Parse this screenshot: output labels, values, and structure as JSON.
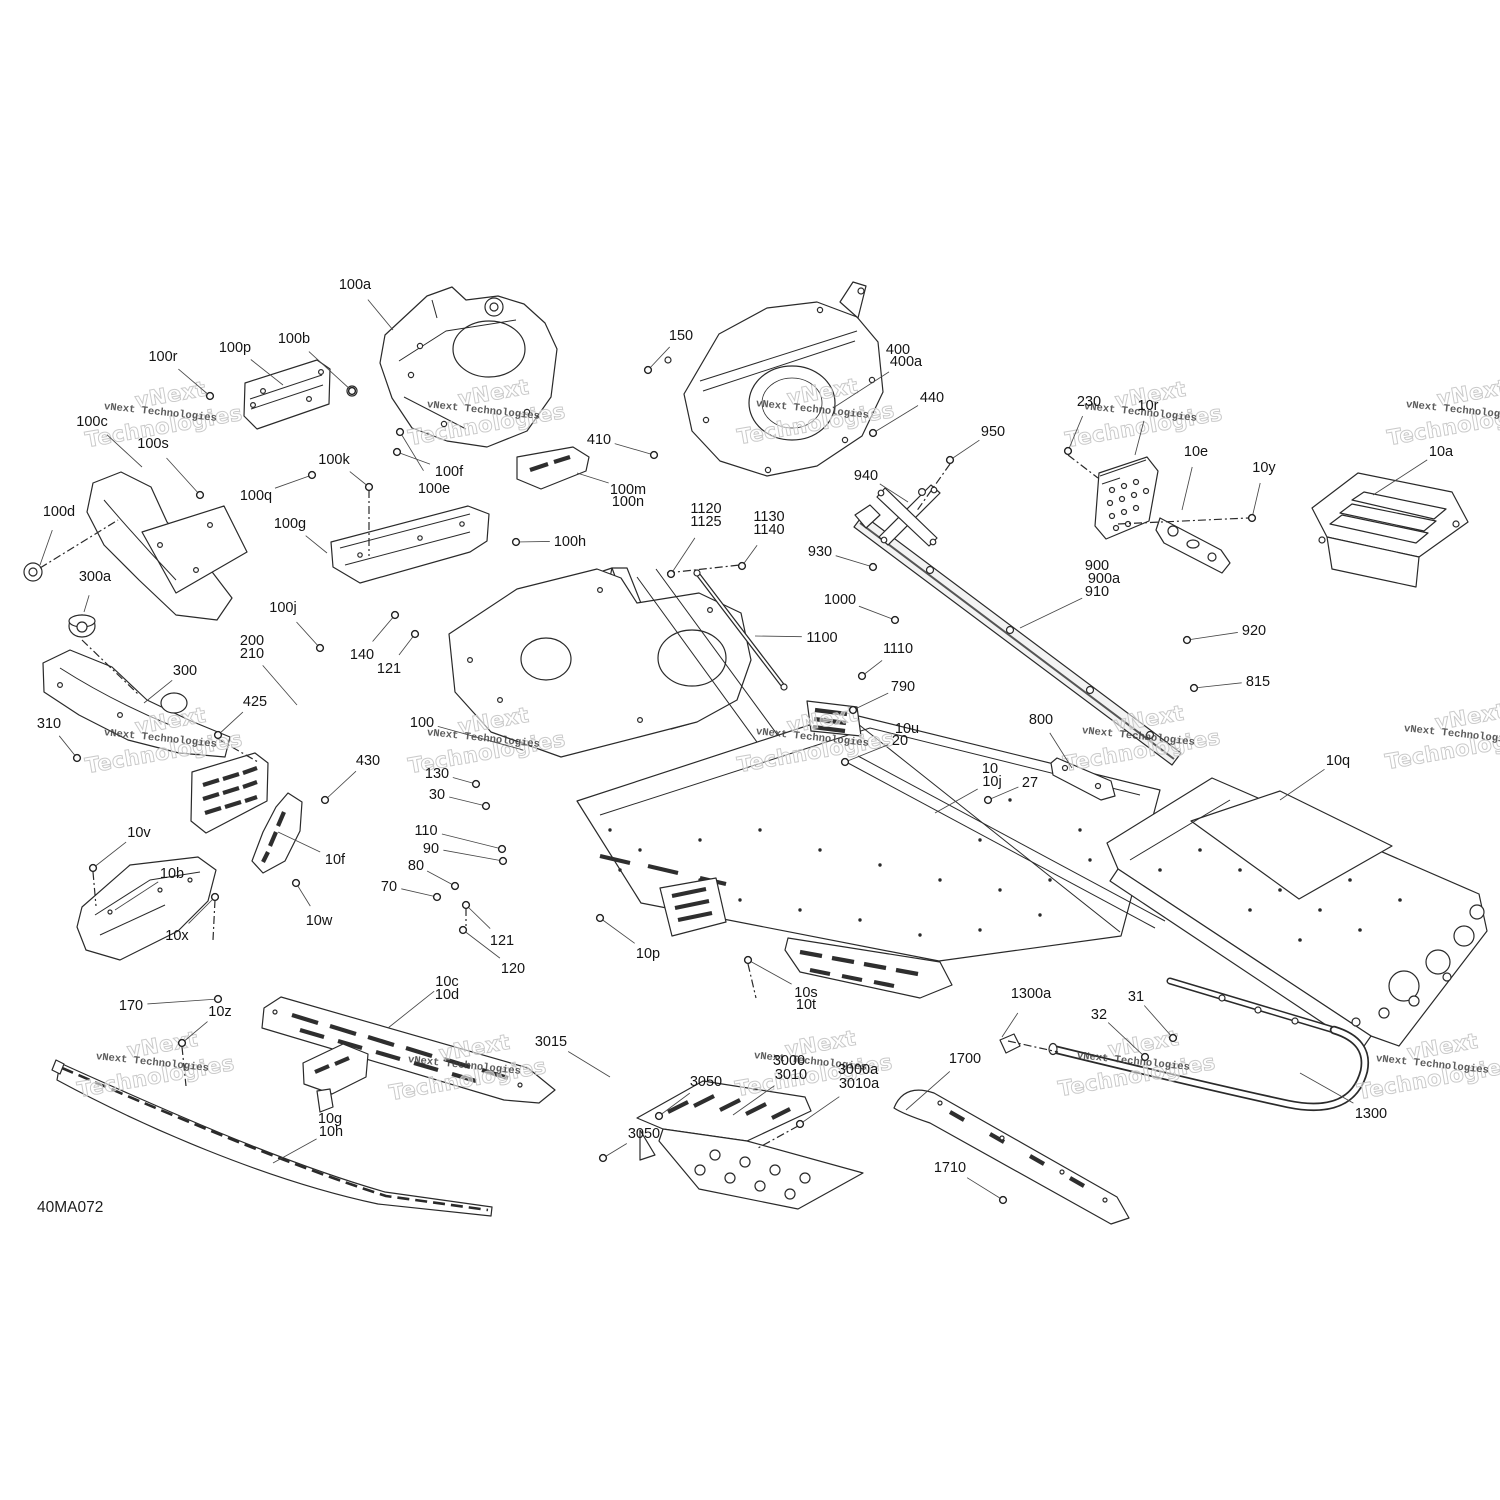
{
  "document": {
    "type": "exploded-parts-diagram",
    "subject": "frame-and-chassis-assembly",
    "drawing_code": "40MA072",
    "watermark": {
      "small": "vNext Technologies",
      "big_line1": "vNext",
      "big_line2": "Technologies"
    },
    "line_color": "#2a2a2a",
    "background_color": "#ffffff"
  },
  "watermark_positions": [
    [
      160,
      416
    ],
    [
      483,
      414
    ],
    [
      812,
      413
    ],
    [
      1140,
      416
    ],
    [
      1462,
      414
    ],
    [
      160,
      742
    ],
    [
      483,
      742
    ],
    [
      812,
      741
    ],
    [
      1138,
      740
    ],
    [
      1460,
      738
    ],
    [
      152,
      1066
    ],
    [
      464,
      1069
    ],
    [
      810,
      1065
    ],
    [
      1133,
      1065
    ],
    [
      1432,
      1068
    ]
  ],
  "labels": [
    {
      "t": "100a",
      "x": 355,
      "y": 284,
      "tx": 393,
      "ty": 330
    },
    {
      "t": "100r",
      "x": 163,
      "y": 356,
      "tx": 210,
      "ty": 396,
      "hw": 1
    },
    {
      "t": "100p",
      "x": 235,
      "y": 347,
      "tx": 283,
      "ty": 385
    },
    {
      "t": "100b",
      "x": 294,
      "y": 338,
      "tx": 352,
      "ty": 391,
      "hw": 1
    },
    {
      "t": "100c",
      "x": 92,
      "y": 421,
      "tx": 142,
      "ty": 467
    },
    {
      "t": "100s",
      "x": 153,
      "y": 443,
      "tx": 200,
      "ty": 495,
      "hw": 1
    },
    {
      "t": "100q",
      "x": 256,
      "y": 495,
      "tx": 312,
      "ty": 475,
      "hw": 1
    },
    {
      "t": "100k",
      "x": 334,
      "y": 459,
      "tx": 369,
      "ty": 487,
      "hw": 1
    },
    {
      "t": "100f",
      "x": 449,
      "y": 471,
      "tx": 397,
      "ty": 452,
      "hw": 1
    },
    {
      "t": "100e",
      "x": 434,
      "y": 488,
      "tx": 400,
      "ty": 432,
      "hw": 1
    },
    {
      "t": "100d",
      "x": 59,
      "y": 511,
      "tx": 40,
      "ty": 565
    },
    {
      "t": "300a",
      "x": 95,
      "y": 576,
      "tx": 84,
      "ty": 612
    },
    {
      "t": "100g",
      "x": 290,
      "y": 523,
      "tx": 327,
      "ty": 553
    },
    {
      "t": "100j",
      "x": 283,
      "y": 607,
      "tx": 320,
      "ty": 648,
      "hw": 1
    },
    {
      "t": "200",
      "x": 252,
      "y": 640
    },
    {
      "t": "210",
      "x": 252,
      "y": 653,
      "tx": 297,
      "ty": 705
    },
    {
      "t": "150",
      "x": 681,
      "y": 335,
      "tx": 648,
      "ty": 370,
      "hw": 1
    },
    {
      "t": "400",
      "x": 898,
      "y": 349
    },
    {
      "t": "400a",
      "x": 906,
      "y": 361,
      "tx": 833,
      "ty": 408
    },
    {
      "t": "440",
      "x": 932,
      "y": 397,
      "tx": 873,
      "ty": 433,
      "hw": 1
    },
    {
      "t": "410",
      "x": 599,
      "y": 439,
      "tx": 654,
      "ty": 455,
      "hw": 1
    },
    {
      "t": "100m",
      "x": 628,
      "y": 489,
      "tx": 577,
      "ty": 473
    },
    {
      "t": "100n",
      "x": 628,
      "y": 501
    },
    {
      "t": "100h",
      "x": 570,
      "y": 541,
      "tx": 516,
      "ty": 542,
      "hw": 1
    },
    {
      "t": "1120",
      "x": 706,
      "y": 508
    },
    {
      "t": "1125",
      "x": 706,
      "y": 521,
      "tx": 671,
      "ty": 574,
      "hw": 1
    },
    {
      "t": "1130",
      "x": 769,
      "y": 516
    },
    {
      "t": "1140",
      "x": 769,
      "y": 529,
      "tx": 742,
      "ty": 566,
      "hw": 1
    },
    {
      "t": "940",
      "x": 866,
      "y": 475,
      "tx": 908,
      "ty": 502
    },
    {
      "t": "950",
      "x": 993,
      "y": 431,
      "tx": 950,
      "ty": 460,
      "hw": 1
    },
    {
      "t": "930",
      "x": 820,
      "y": 551,
      "tx": 873,
      "ty": 567,
      "hw": 1
    },
    {
      "t": "1000",
      "x": 840,
      "y": 599,
      "tx": 895,
      "ty": 620,
      "hw": 1
    },
    {
      "t": "1100",
      "x": 822,
      "y": 637,
      "tx": 755,
      "ty": 636
    },
    {
      "t": "1110",
      "x": 898,
      "y": 648,
      "tx": 862,
      "ty": 676,
      "hw": 1
    },
    {
      "t": "230",
      "x": 1089,
      "y": 401,
      "tx": 1068,
      "ty": 451,
      "hw": 1
    },
    {
      "t": "10r",
      "x": 1148,
      "y": 405,
      "tx": 1135,
      "ty": 455
    },
    {
      "t": "10e",
      "x": 1196,
      "y": 451,
      "tx": 1182,
      "ty": 510
    },
    {
      "t": "10y",
      "x": 1264,
      "y": 467,
      "tx": 1252,
      "ty": 518,
      "hw": 1
    },
    {
      "t": "10a",
      "x": 1441,
      "y": 451,
      "tx": 1373,
      "ty": 495
    },
    {
      "t": "900",
      "x": 1097,
      "y": 565
    },
    {
      "t": "900a",
      "x": 1104,
      "y": 578
    },
    {
      "t": "910",
      "x": 1097,
      "y": 591,
      "tx": 1020,
      "ty": 628
    },
    {
      "t": "920",
      "x": 1254,
      "y": 630,
      "tx": 1187,
      "ty": 640,
      "hw": 1
    },
    {
      "t": "815",
      "x": 1258,
      "y": 681,
      "tx": 1194,
      "ty": 688,
      "hw": 1
    },
    {
      "t": "10q",
      "x": 1338,
      "y": 760,
      "tx": 1280,
      "ty": 800
    },
    {
      "t": "800",
      "x": 1041,
      "y": 719,
      "tx": 1072,
      "ty": 768
    },
    {
      "t": "790",
      "x": 903,
      "y": 686,
      "tx": 853,
      "ty": 710,
      "hw": 1
    },
    {
      "t": "10u",
      "x": 907,
      "y": 728
    },
    {
      "t": "20",
      "x": 900,
      "y": 740,
      "tx": 845,
      "ty": 762,
      "hw": 1
    },
    {
      "t": "10",
      "x": 990,
      "y": 768
    },
    {
      "t": "10j",
      "x": 992,
      "y": 781,
      "tx": 935,
      "ty": 813
    },
    {
      "t": "27",
      "x": 1030,
      "y": 782,
      "tx": 988,
      "ty": 800,
      "hw": 1
    },
    {
      "t": "100",
      "x": 422,
      "y": 722,
      "tx": 523,
      "ty": 750
    },
    {
      "t": "130",
      "x": 437,
      "y": 773,
      "tx": 476,
      "ty": 784,
      "hw": 1
    },
    {
      "t": "30",
      "x": 437,
      "y": 794,
      "tx": 486,
      "ty": 806,
      "hw": 1
    },
    {
      "t": "110",
      "x": 426,
      "y": 830,
      "tx": 502,
      "ty": 849,
      "hw": 1
    },
    {
      "t": "90",
      "x": 431,
      "y": 848,
      "tx": 503,
      "ty": 861,
      "hw": 1
    },
    {
      "t": "80",
      "x": 416,
      "y": 865,
      "tx": 455,
      "ty": 886,
      "hw": 1
    },
    {
      "t": "70",
      "x": 389,
      "y": 886,
      "tx": 437,
      "ty": 897,
      "hw": 1
    },
    {
      "t": "121",
      "x": 389,
      "y": 668,
      "tx": 415,
      "ty": 634,
      "hw": 1
    },
    {
      "t": "140",
      "x": 362,
      "y": 654,
      "tx": 395,
      "ty": 615,
      "hw": 1
    },
    {
      "t": "300",
      "x": 185,
      "y": 670,
      "tx": 144,
      "ty": 703
    },
    {
      "t": "310",
      "x": 49,
      "y": 723,
      "tx": 77,
      "ty": 758,
      "hw": 1
    },
    {
      "t": "425",
      "x": 255,
      "y": 701,
      "tx": 218,
      "ty": 735,
      "hw": 1
    },
    {
      "t": "430",
      "x": 368,
      "y": 760,
      "tx": 325,
      "ty": 800,
      "hw": 1
    },
    {
      "t": "10v",
      "x": 139,
      "y": 832,
      "tx": 93,
      "ty": 868,
      "hw": 1
    },
    {
      "t": "10b",
      "x": 172,
      "y": 873,
      "tx": 115,
      "ty": 910
    },
    {
      "t": "10x",
      "x": 177,
      "y": 935,
      "tx": 215,
      "ty": 897,
      "hw": 1
    },
    {
      "t": "10f",
      "x": 335,
      "y": 859,
      "tx": 278,
      "ty": 832
    },
    {
      "t": "10w",
      "x": 319,
      "y": 920,
      "tx": 296,
      "ty": 883,
      "hw": 1
    },
    {
      "t": "121",
      "x": 502,
      "y": 940,
      "tx": 466,
      "ty": 905,
      "hw": 1
    },
    {
      "t": "120",
      "x": 513,
      "y": 968,
      "tx": 463,
      "ty": 930,
      "hw": 1
    },
    {
      "t": "10p",
      "x": 648,
      "y": 953,
      "tx": 600,
      "ty": 918,
      "hw": 1
    },
    {
      "t": "10s",
      "x": 806,
      "y": 992,
      "tx": 748,
      "ty": 960,
      "hw": 1
    },
    {
      "t": "10t",
      "x": 806,
      "y": 1004
    },
    {
      "t": "10c",
      "x": 447,
      "y": 981,
      "tx": 388,
      "ty": 1028
    },
    {
      "t": "10d",
      "x": 447,
      "y": 994
    },
    {
      "t": "170",
      "x": 131,
      "y": 1005,
      "tx": 218,
      "ty": 999,
      "hw": 1
    },
    {
      "t": "10z",
      "x": 220,
      "y": 1011,
      "tx": 182,
      "ty": 1043,
      "hw": 1
    },
    {
      "t": "10g",
      "x": 330,
      "y": 1118
    },
    {
      "t": "10h",
      "x": 331,
      "y": 1131,
      "tx": 273,
      "ty": 1163
    },
    {
      "t": "3015",
      "x": 551,
      "y": 1041,
      "tx": 610,
      "ty": 1077
    },
    {
      "t": "3050",
      "x": 706,
      "y": 1081,
      "tx": 659,
      "ty": 1116,
      "hw": 1
    },
    {
      "t": "3050",
      "x": 644,
      "y": 1133,
      "tx": 603,
      "ty": 1158,
      "hw": 1
    },
    {
      "t": "3000",
      "x": 789,
      "y": 1060
    },
    {
      "t": "3010",
      "x": 791,
      "y": 1074,
      "tx": 733,
      "ty": 1115
    },
    {
      "t": "3000a",
      "x": 858,
      "y": 1069
    },
    {
      "t": "3010a",
      "x": 859,
      "y": 1083,
      "tx": 800,
      "ty": 1124,
      "hw": 1
    },
    {
      "t": "1700",
      "x": 965,
      "y": 1058,
      "tx": 906,
      "ty": 1110
    },
    {
      "t": "1710",
      "x": 950,
      "y": 1167,
      "tx": 1003,
      "ty": 1200,
      "hw": 1
    },
    {
      "t": "1300a",
      "x": 1031,
      "y": 993,
      "tx": 1002,
      "ty": 1037
    },
    {
      "t": "32",
      "x": 1099,
      "y": 1014,
      "tx": 1145,
      "ty": 1057,
      "hw": 1
    },
    {
      "t": "31",
      "x": 1136,
      "y": 996,
      "tx": 1173,
      "ty": 1038,
      "hw": 1
    },
    {
      "t": "1300",
      "x": 1371,
      "y": 1113,
      "tx": 1300,
      "ty": 1073
    }
  ]
}
